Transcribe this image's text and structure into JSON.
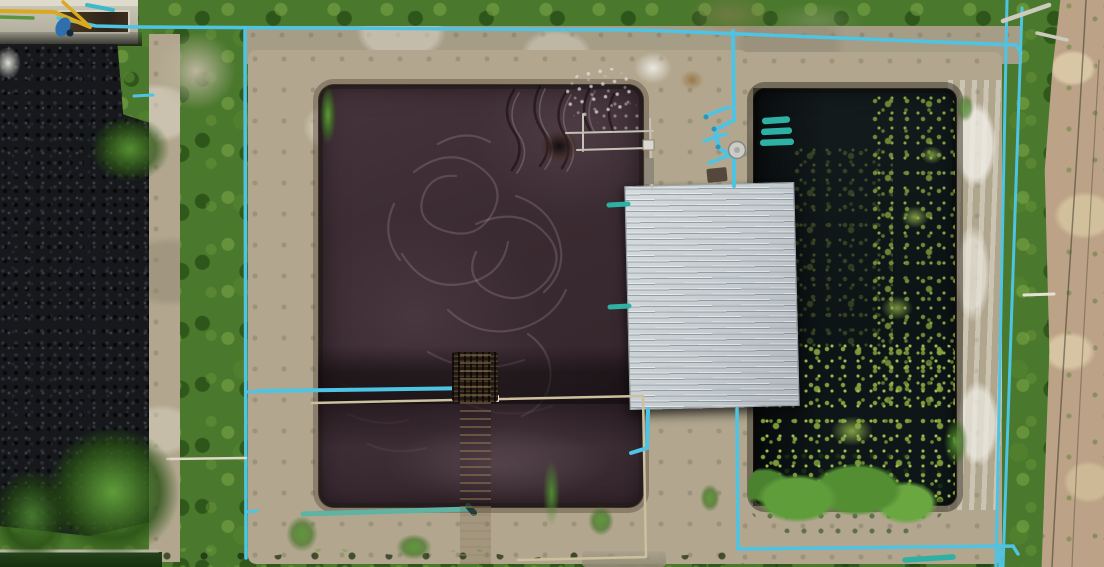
{
  "scene": {
    "type": "aerial-drone-photograph",
    "subject": "wastewater treatment facility with two rectangular treatment ponds, blue PVC piping, corrugated metal pump-house roof, concrete walls, grass, gravel and sandy ground",
    "regions": [
      {
        "name": "machinery-walkway",
        "label": "concrete walkway with yellow boom and equipment, top-left"
      },
      {
        "name": "gravel-field",
        "label": "dark gravel field, left"
      },
      {
        "name": "main-treatment-pond",
        "label": "large dark maroon wastewater pond with foam swirls"
      },
      {
        "name": "pump-house-roof",
        "label": "light gray corrugated metal roof"
      },
      {
        "name": "settling-pond",
        "label": "dark pond with green algae speckles, right"
      },
      {
        "name": "pvc-pipe-network",
        "label": "cyan PVC pipes along walls and perimeter"
      },
      {
        "name": "access-ladder",
        "label": "dark wooden catwalk ladder across pond wall"
      },
      {
        "name": "dirt-ground",
        "label": "sandy dirt strip, far right"
      },
      {
        "name": "grass-strips",
        "label": "green grass strips between structures"
      }
    ],
    "palette": {
      "grass_base": "#4a782c",
      "grass_dark": "#2c541a",
      "grass_light": "#74a342",
      "gravel": "#16181c",
      "concrete": "#b2a78e",
      "concrete_light": "#d7d2c0",
      "pond_main": "#46343c",
      "pond_swirl": "#d6bcc4",
      "pond_right": "#0d1416",
      "algae": "#8aa83e",
      "algae_bright": "#a9c653",
      "veg": "#5d9a38",
      "roof": "#d5dbde",
      "roof_line": "#9aa3a8",
      "pipe_blue": "#4ec4e4",
      "pipe_teal": "#2fb0a4",
      "pipe_beige": "#cdc09e",
      "pipe_white": "#ddd8ca",
      "dirt": "#bca387",
      "dirt_light": "#d9c6a5",
      "ladder_wood": "#15100c",
      "machine_yellow": "#d9a91f",
      "metal_pole": "#c6c1b5"
    }
  }
}
